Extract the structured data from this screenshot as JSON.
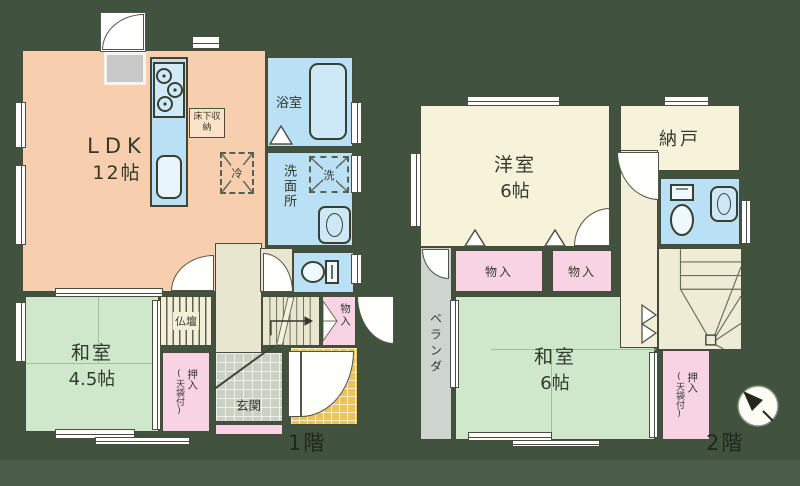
{
  "title": "間取り図",
  "colors": {
    "background": "#41523f",
    "ldk": "#f7cfae",
    "wet_area_blue": "#b9e0f4",
    "tatami_green": "#cfe8cc",
    "western_cream": "#f7f3da",
    "closet_pink": "#f8d3e3",
    "porch_yellow": "#eac456",
    "veranda_gray": "#ced5ce",
    "genkan_gray": "#cad0c2"
  },
  "floor1": {
    "label": "1階",
    "ldk": {
      "name": "LDK",
      "size": "12帖"
    },
    "bathroom": {
      "name": "浴室"
    },
    "washroom": {
      "name": "洗面所"
    },
    "washer": {
      "name": "洗"
    },
    "fridge": {
      "name": "冷"
    },
    "underfloor_storage": {
      "name": "床下収納"
    },
    "washitsu": {
      "name": "和室",
      "size": "4.5帖"
    },
    "butsudan": {
      "name": "仏壇"
    },
    "oshiire": {
      "name": "押入",
      "note": "(天袋付)"
    },
    "monoire": {
      "name": "物入"
    },
    "genkan": {
      "name": "玄関"
    }
  },
  "floor2": {
    "label": "2階",
    "yoshitsu": {
      "name": "洋室",
      "size": "6帖"
    },
    "nando": {
      "name": "納戸"
    },
    "veranda": {
      "name": "ベランダ"
    },
    "washitsu": {
      "name": "和室",
      "size": "6帖"
    },
    "monoire_a": {
      "name": "物入"
    },
    "monoire_b": {
      "name": "物入"
    },
    "monoire_tenbukuro": {
      "name": "物入",
      "note": "(天袋付)"
    },
    "oshiire": {
      "name": "押入",
      "note": "(天袋付)"
    }
  }
}
